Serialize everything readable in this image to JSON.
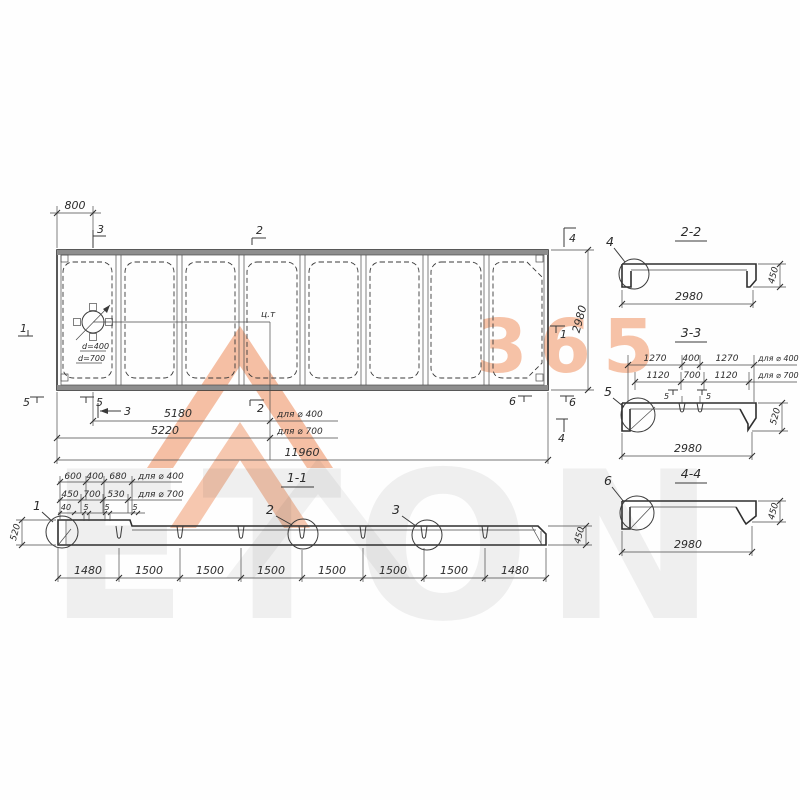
{
  "brand": {
    "digits": "365",
    "letters": "ETON"
  },
  "plan": {
    "dims": {
      "d800": "800",
      "v2980": "2980",
      "d5180": "5180",
      "d5220": "5220",
      "d11960": "11960",
      "for400": "для ⌀ 400",
      "for700": "для ⌀ 700"
    },
    "hole": {
      "d400": "d=400",
      "d700": "d=700"
    },
    "centroid": "ц.т",
    "marks": {
      "m3t": "3",
      "m2t": "2",
      "m4t": "4",
      "m1l": "1",
      "m1r": "1",
      "m5a": "5",
      "m5b": "5",
      "m3b": "3",
      "m2b": "2",
      "m6a": "6",
      "m6b": "6",
      "m4b": "4"
    }
  },
  "s11": {
    "title": "1-1",
    "rowA": [
      "600",
      "400",
      "680"
    ],
    "rowA_label": "для ⌀ 400",
    "rowB": [
      "450",
      "700",
      "530"
    ],
    "rowB_label": "для ⌀ 700",
    "rowC": [
      "40",
      "5",
      "5",
      "5"
    ],
    "chain": [
      "1480",
      "1500",
      "1500",
      "1500",
      "1500",
      "1500",
      "1500",
      "1480"
    ],
    "h_left": "520",
    "h_right": "450",
    "details": [
      "1",
      "2",
      "3"
    ]
  },
  "s22": {
    "title": "2-2",
    "detail": "4",
    "w": "2980",
    "h": "450"
  },
  "s33": {
    "title": "3-3",
    "detail": "5",
    "w": "2980",
    "h": "520",
    "rowA": [
      "1270",
      "400",
      "1270"
    ],
    "rowA_label": "для ⌀ 400",
    "rowB": [
      "1120",
      "700",
      "1120"
    ],
    "rowB_label": "для ⌀ 700",
    "small": [
      "5",
      "5"
    ]
  },
  "s44": {
    "title": "4-4",
    "detail": "6",
    "w": "2980",
    "h": "450"
  }
}
